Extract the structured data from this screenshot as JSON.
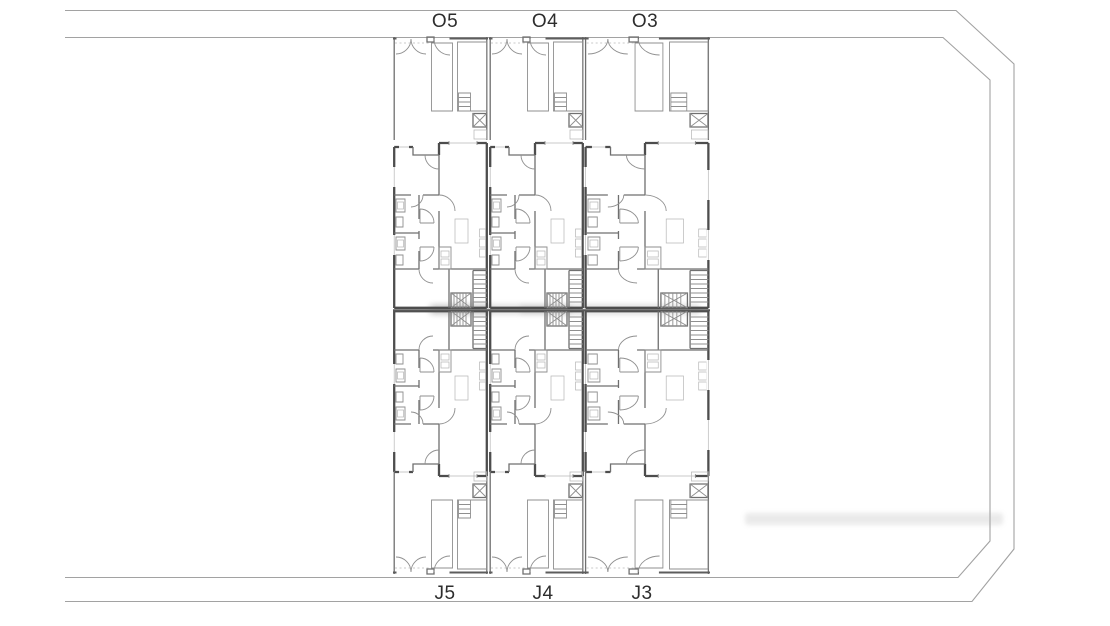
{
  "drawing_labels": {
    "top_row": [
      "O5",
      "O4",
      "O3"
    ],
    "bottom_row": [
      "J5",
      "J4",
      "J3"
    ]
  },
  "colors": {
    "background": "#ffffff",
    "boundary": "#a2a2a2",
    "wall_dark": "#4d4d4d",
    "wall_mid": "#6f6f6f",
    "wall_light": "#8f8f8f",
    "detail": "#b6b6b6",
    "label": "#2d2d2d",
    "watermark": "#a8a8a8"
  }
}
